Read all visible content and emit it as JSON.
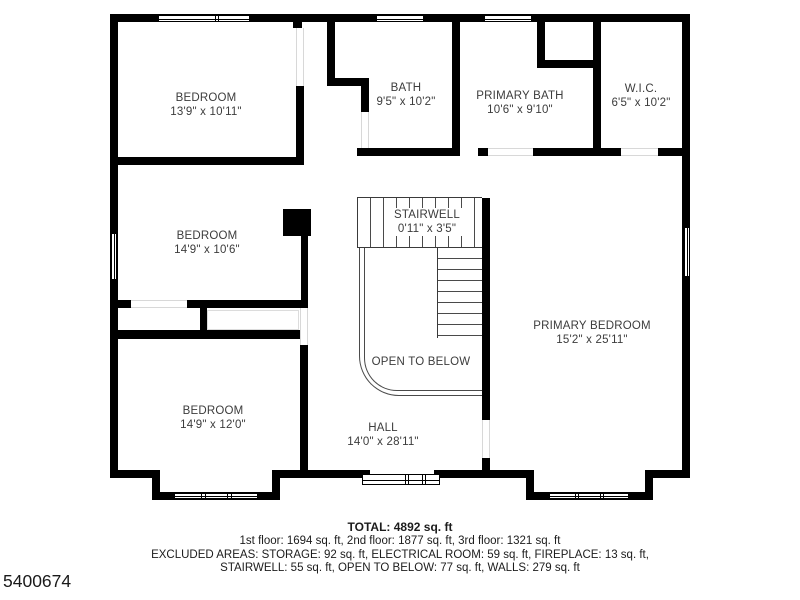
{
  "title_block": {
    "plan_id": "5400674"
  },
  "rooms": [
    {
      "id": "bedroom-1",
      "name": "BEDROOM",
      "dims": "13'9\" x 10'11\""
    },
    {
      "id": "bath",
      "name": "BATH",
      "dims": "9'5\" x 10'2\""
    },
    {
      "id": "primary-bath",
      "name": "PRIMARY BATH",
      "dims": "10'6\" x 9'10\""
    },
    {
      "id": "wic",
      "name": "W.I.C.",
      "dims": "6'5\" x 10'2\""
    },
    {
      "id": "bedroom-2",
      "name": "BEDROOM",
      "dims": "14'9\" x 10'6\""
    },
    {
      "id": "stairwell",
      "name": "STAIRWELL",
      "dims": "0'11\" x 3'5\""
    },
    {
      "id": "primary-bedroom",
      "name": "PRIMARY BEDROOM",
      "dims": "15'2\" x 25'11\""
    },
    {
      "id": "bedroom-3",
      "name": "BEDROOM",
      "dims": "14'9\" x 12'0\""
    },
    {
      "id": "hall",
      "name": "HALL",
      "dims": "14'0\" x 28'11\""
    },
    {
      "id": "open-to-below",
      "name": "OPEN TO BELOW",
      "dims": ""
    }
  ],
  "summary": {
    "total": "TOTAL: 4892 sq. ft",
    "floors": "1st floor: 1694 sq. ft, 2nd floor: 1877 sq. ft, 3rd floor: 1321 sq. ft",
    "excluded_1": "EXCLUDED AREAS: STORAGE: 92 sq. ft, ELECTRICAL ROOM: 59 sq. ft, FIREPLACE: 13 sq. ft,",
    "excluded_2": "STAIRWELL: 55 sq. ft, OPEN TO BELOW: 77 sq. ft, WALLS: 279 sq. ft"
  },
  "colors": {
    "wall": "#000000",
    "background": "#ffffff",
    "label_text": "#3c3c3c"
  }
}
